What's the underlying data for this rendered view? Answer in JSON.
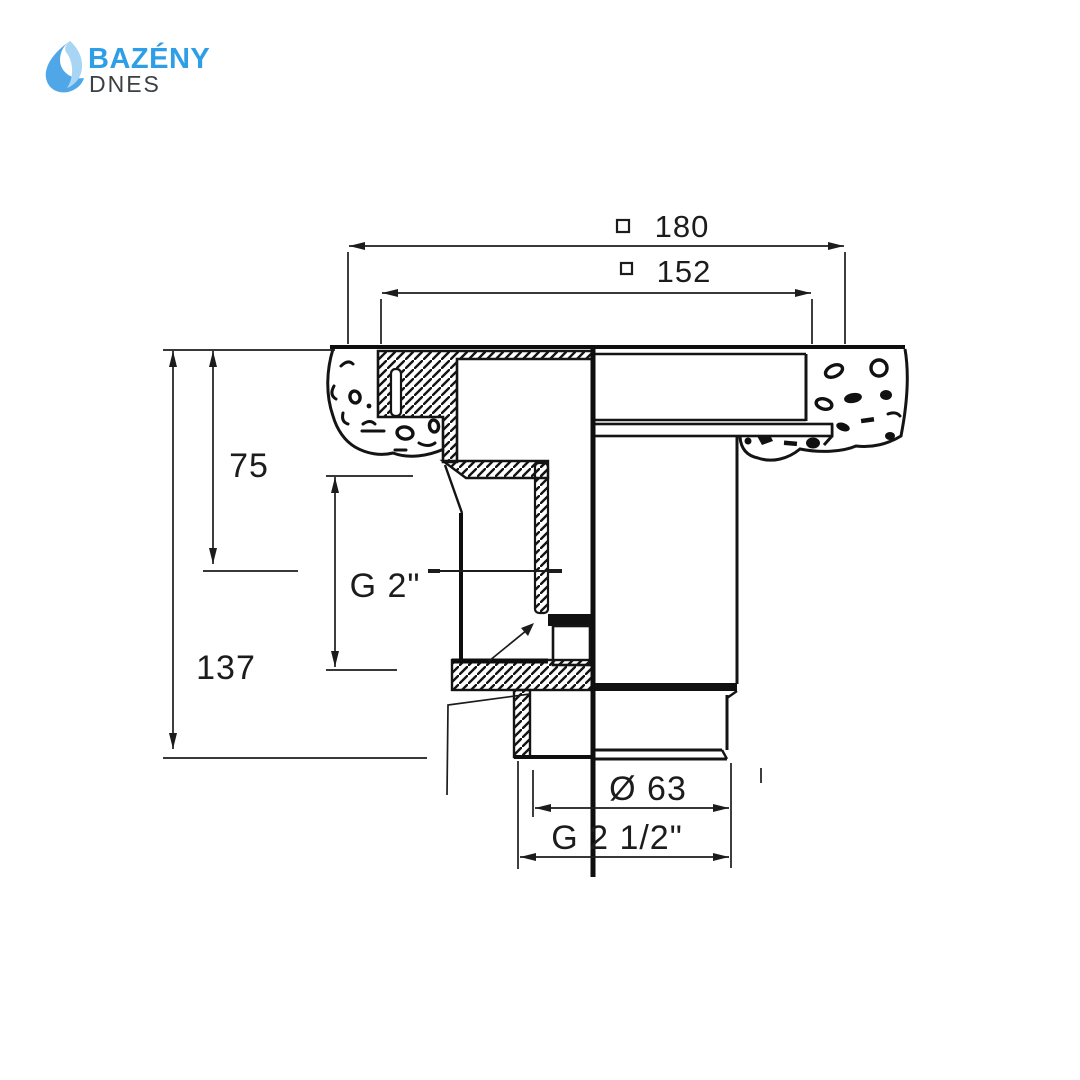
{
  "logo": {
    "brand": "BAZÉNY",
    "sub": "DNES"
  },
  "colors": {
    "brand_blue": "#2E9EE7",
    "icon_light": "#A8D5F3",
    "icon_mid": "#4FA7E8",
    "sub_gray": "#3C4043",
    "ink": "#1A1A1A"
  },
  "drawing": {
    "type": "technical-cross-section",
    "dims": {
      "outer_width": "180",
      "inner_width": "152",
      "port_axis_depth": "75",
      "total_depth": "137",
      "side_thread": "G 2\"",
      "outlet_diameter": "Ø 63",
      "outlet_thread": "G 2 1/2\""
    }
  }
}
